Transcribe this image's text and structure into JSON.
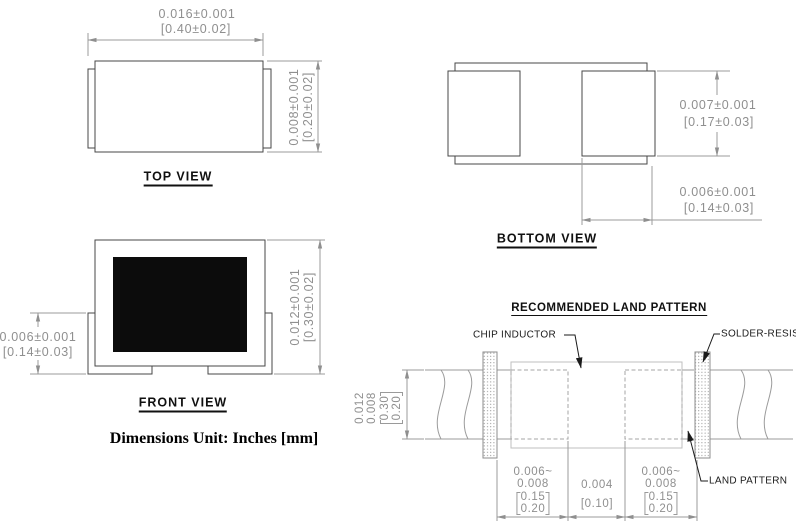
{
  "drawing": {
    "units_note": "Dimensions Unit: Inches [mm]",
    "top_view": {
      "label": "TOP VIEW",
      "length_in": "0.016±0.001",
      "length_mm": "[0.40±0.02]",
      "width_in": "0.008±0.001",
      "width_mm": "[0.20±0.02]"
    },
    "bottom_view": {
      "label": "BOTTOM VIEW",
      "pad_height_in": "0.007±0.001",
      "pad_height_mm": "[0.17±0.03]",
      "pad_width_in": "0.006±0.001",
      "pad_width_mm": "[0.14±0.03]"
    },
    "front_view": {
      "label": "FRONT VIEW",
      "terminal_height_in": "0.006±0.001",
      "terminal_height_mm": "[0.14±0.03]",
      "height_in": "0.012±0.001",
      "height_mm": "[0.30±0.02]"
    },
    "land_pattern": {
      "title": "RECOMMENDED LAND PATTERN",
      "chip_inductor_label": "CHIP INDUCTOR",
      "solder_resist_label": "SOLDER-RESIST",
      "land_pattern_label": "LAND PATTERN",
      "band_in_1": "0.012",
      "band_in_2": "0.008",
      "band_mm_1": "0.30",
      "band_mm_2": "0.20",
      "pad_left_in_1": "0.006~",
      "pad_left_in_2": "0.008",
      "pad_left_mm_1": "0.15",
      "pad_left_mm_2": "0.20",
      "gap_in": "0.004",
      "gap_mm": "[0.10]",
      "pad_right_in_1": "0.006~",
      "pad_right_in_2": "0.008",
      "pad_right_mm_1": "0.15",
      "pad_right_mm_2": "0.20"
    }
  },
  "colors": {
    "dimension_gray": "#8f8f8f",
    "outline_dark": "#474747",
    "outline_light": "#bfbfbf",
    "core_black": "#0c0c0c",
    "label_black": "#101010"
  }
}
